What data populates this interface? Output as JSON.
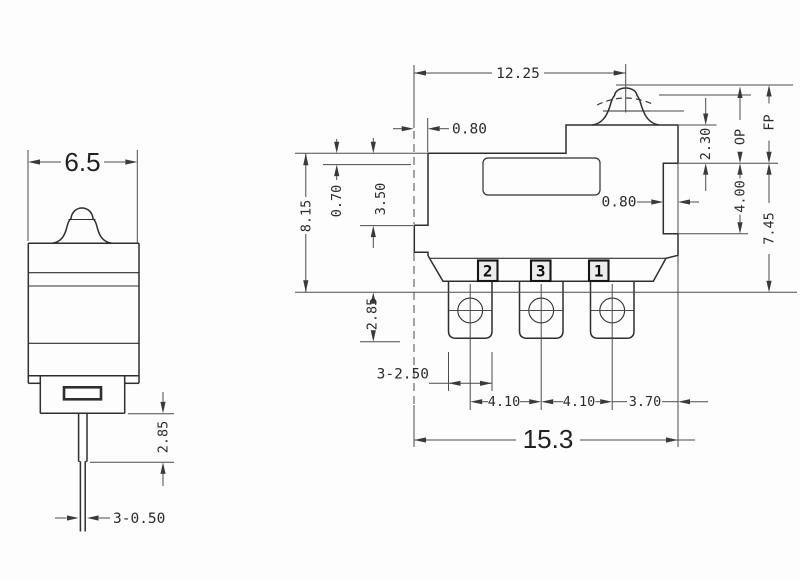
{
  "drawing": {
    "side_view": {
      "width": "6.5",
      "pin_length": "2.85",
      "pin_width": "3-0.50"
    },
    "front_view": {
      "top_width": "12.25",
      "left_step": "0.80",
      "body_height": "8.15",
      "lever_gap": "0.70",
      "upper_height": "3.50",
      "button_height": "2.30",
      "op_label": "OP",
      "fp_label": "FP",
      "notch_height": "4.00",
      "overall_height": "7.45",
      "notch_depth": "0.80",
      "terminal_length": "2.85",
      "terminal_width": "3-2.50",
      "pitch_left": "4.10",
      "pitch_right": "4.10",
      "edge_offset": "3.70",
      "overall_width": "15.3",
      "terminal_numbers": [
        "2",
        "3",
        "1"
      ]
    }
  }
}
